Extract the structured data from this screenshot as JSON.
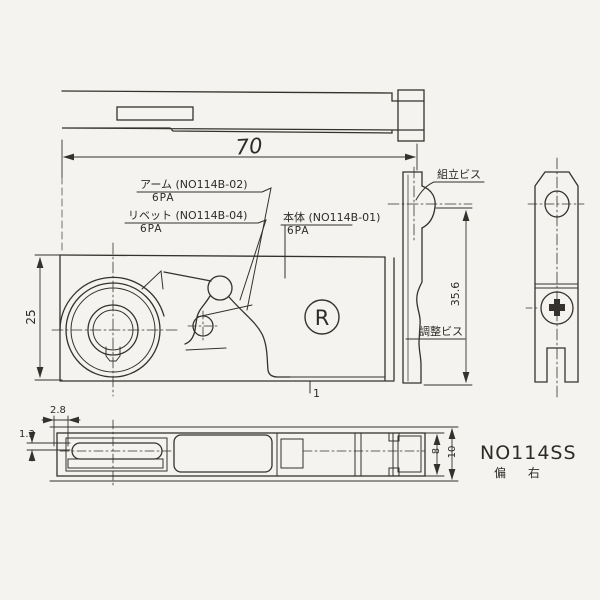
{
  "page": {
    "background": "#f4f3ef",
    "ink": "#35322d"
  },
  "title_block": {
    "part_number": "NO114SS",
    "variant_note": "偏 右"
  },
  "callouts": {
    "arm": {
      "label": "アーム (NO114B-02)",
      "qty": "6PA"
    },
    "rivet": {
      "label": "リベット (NO114B-04)",
      "qty": "6PA"
    },
    "body": {
      "label": "本体 (NO114B-01)",
      "qty": "6PA"
    },
    "assembly_screw": {
      "label": "組立ビス"
    },
    "adjustment_screw": {
      "label": "調整ビス"
    },
    "right_hand_mark": "R"
  },
  "dimensions": {
    "overall_length": "70",
    "front_height": "25",
    "side_height": "35.6",
    "edge_offset": "2.8",
    "lip_thickness": "1.3",
    "inner_depth": "8",
    "outer_depth": "10",
    "plate_thickness": "1"
  }
}
